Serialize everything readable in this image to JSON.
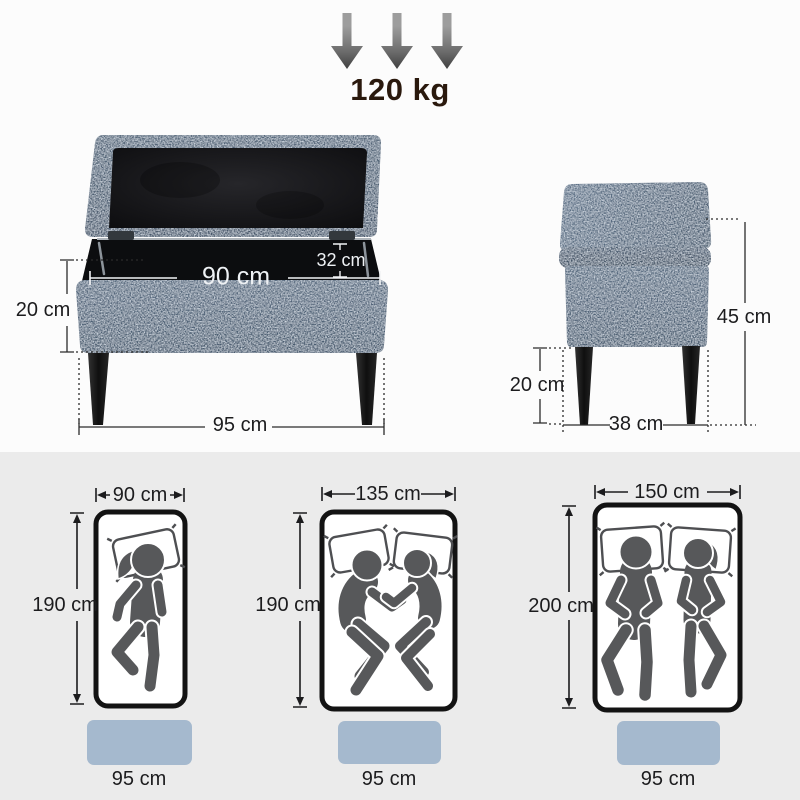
{
  "infographic": {
    "weight_capacity": "120 kg",
    "front_view": {
      "interior_width": "90 cm",
      "interior_depth": "32 cm",
      "base_height": "20 cm",
      "overall_width": "95 cm"
    },
    "side_view": {
      "overall_height": "45 cm",
      "leg_height": "20 cm",
      "depth": "38 cm"
    },
    "bed_compatibility": [
      {
        "bed_width": "90 cm",
        "bed_length": "190 cm",
        "bench_width": "95 cm",
        "icon": "single-sleeper-icon"
      },
      {
        "bed_width": "135 cm",
        "bed_length": "190 cm",
        "bench_width": "95 cm",
        "icon": "couple-side-sleepers-icon"
      },
      {
        "bed_width": "150 cm",
        "bed_length": "200 cm",
        "bench_width": "95 cm",
        "icon": "couple-back-sleepers-icon"
      }
    ],
    "colors": {
      "fabric_blue": "#4f6378",
      "bench_marker_blue": "#a5b9ce",
      "bottom_section_bg": "#ebebeb",
      "figure_gray": "#57585a",
      "weight_text": "#2a190d"
    }
  }
}
